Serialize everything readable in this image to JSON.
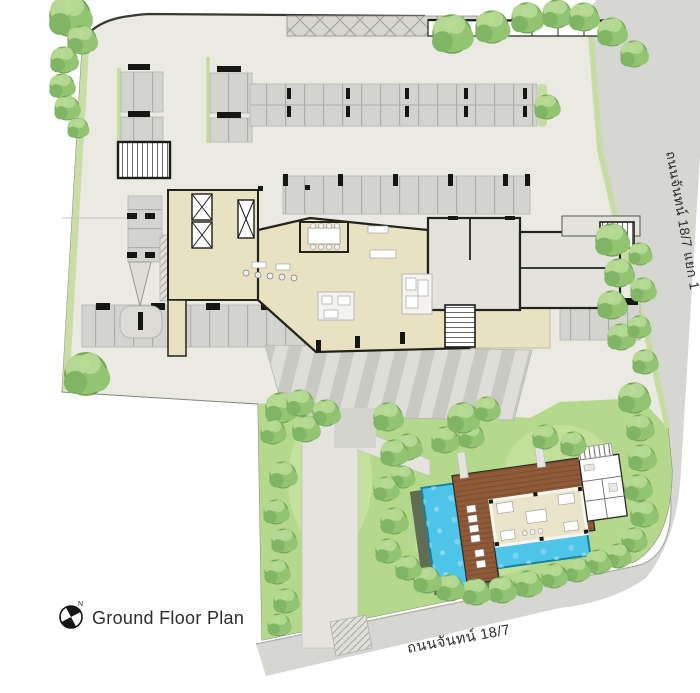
{
  "labels": {
    "title": "Ground Floor Plan",
    "road_right": "ถนนจันทน์ 18/7 แยก 1",
    "road_bottom": "ถนนจันทน์ 18/7",
    "north": "N"
  },
  "colors": {
    "background": "#ffffff",
    "ground": "#eae9e2",
    "road": "#d6d6d2",
    "curb": "#b0b0aa",
    "boundary": "#85857c",
    "grass": "#b5d98c",
    "grass_light": "#cfe8ab",
    "verge": "#c7dca2",
    "stall": "#d3d3d0",
    "stall_line": "#aeaea9",
    "stripe": "#c9c9c4",
    "path": "#e4e3dd",
    "lobby": "#e8e1c2",
    "room_gray": "#e3e2dc",
    "wall": "#23231e",
    "pool": "#4ec4e8",
    "pool_edge": "#17809e",
    "deck": "#8e5a38",
    "deck_line": "#714327",
    "planter": "#55604c",
    "tree_dark": "#6fa150",
    "tree_mid": "#92c471",
    "tree_light": "#b9dc96",
    "text": "#2d2d2a"
  }
}
